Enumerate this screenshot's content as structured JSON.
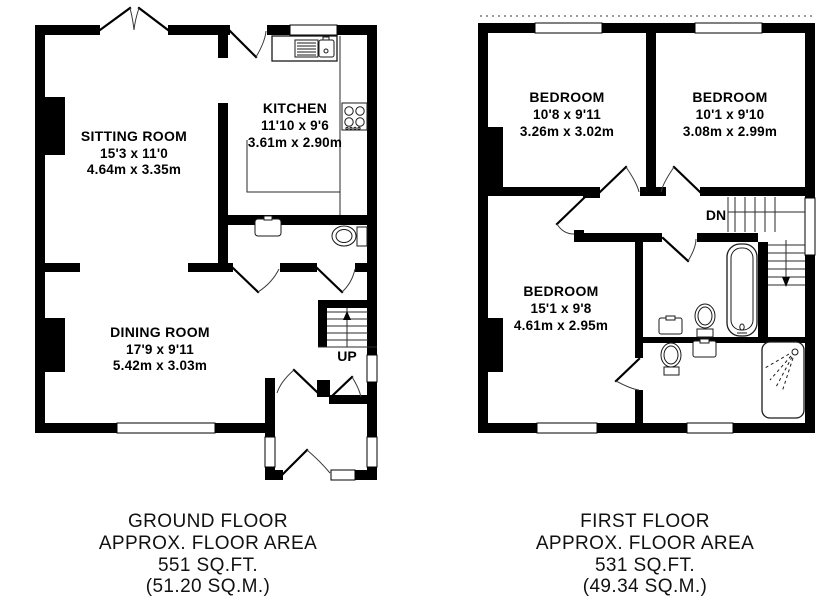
{
  "ground_floor": {
    "rooms": [
      {
        "name": "SITTING ROOM",
        "size_imperial": "15'3 x 11'0",
        "size_metric": "4.64m x 3.35m"
      },
      {
        "name": "KITCHEN",
        "size_imperial": "11'10 x 9'6",
        "size_metric": "3.61m x 2.90m"
      },
      {
        "name": "DINING ROOM",
        "size_imperial": "17'9 x 9'11",
        "size_metric": "5.42m x 3.03m"
      }
    ],
    "stair_label": "UP",
    "caption": [
      "GROUND FLOOR",
      "APPROX. FLOOR AREA",
      "551 SQ.FT.",
      "(51.20 SQ.M.)"
    ]
  },
  "first_floor": {
    "rooms": [
      {
        "name": "BEDROOM",
        "size_imperial": "10'8 x 9'11",
        "size_metric": "3.26m x 3.02m"
      },
      {
        "name": "BEDROOM",
        "size_imperial": "10'1 x 9'10",
        "size_metric": "3.08m x 2.99m"
      },
      {
        "name": "BEDROOM",
        "size_imperial": "15'1 x 9'8",
        "size_metric": "4.61m x 2.95m"
      }
    ],
    "stair_label": "DN",
    "caption": [
      "FIRST FLOOR",
      "APPROX. FLOOR AREA",
      "531 SQ.FT.",
      "(49.34 SQ.M.)"
    ]
  },
  "colors": {
    "wall": "#000000",
    "background": "#ffffff",
    "line": "#1a1a1a"
  }
}
